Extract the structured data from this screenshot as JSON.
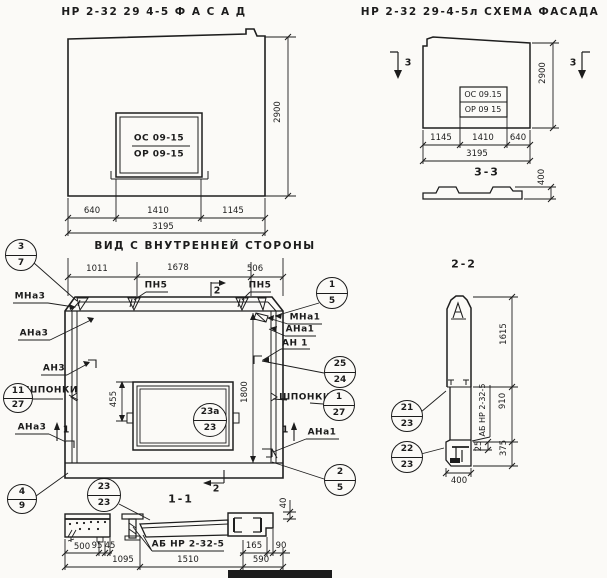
{
  "facade": {
    "title": "НР 2-32 29 4-5   Ф А С А Д",
    "window_top": "ОС 09-15",
    "window_bottom": "ОР 09-15",
    "dim_height": "2900",
    "dim_640": "640",
    "dim_1410": "1410",
    "dim_1145": "1145",
    "dim_total": "3195"
  },
  "scheme": {
    "title": "НР 2-32 29-4-5л  СХЕМА ФАСАДА",
    "window_top": "ОС 09.15",
    "window_bottom": "ОР 09 15",
    "dim_height": "2900",
    "dim_1145": "1145",
    "dim_1410": "1410",
    "dim_640": "640",
    "dim_total": "3195",
    "mark_left": "3",
    "mark_right": "3",
    "sec_title": "3-3",
    "dim_400": "400"
  },
  "inner": {
    "title": "ВИД С ВНУТРЕННЕЙ СТОРОНЫ",
    "dim_1011": "1011",
    "dim_1678": "1678",
    "dim_506": "506",
    "pn5_left": "ПН5",
    "pn5_right": "ПН5",
    "flag2_top": "2",
    "flag2_bottom": "2",
    "flag1_left": "1",
    "flag1_right": "1",
    "mna3": "МНа3",
    "ana3": "АНа3",
    "an3": "АН3",
    "shponki_left": "ШПОНКИ",
    "ana3_b": "АНа3",
    "mna1": "МНа1",
    "ana1": "АНа1",
    "an1": "АН 1",
    "shponki_right": "ШПОНКИ",
    "ana1_b": "АНа1",
    "dim_455": "455",
    "dim_1800": "1800"
  },
  "balloons": {
    "b3_7": {
      "top": "3",
      "bottom": "7"
    },
    "b11_27": {
      "top": "11",
      "bottom": "27"
    },
    "b4_9": {
      "top": "4",
      "bottom": "9"
    },
    "b1_5": {
      "top": "1",
      "bottom": "5"
    },
    "b25_24": {
      "top": "25",
      "bottom": "24"
    },
    "b1_27": {
      "top": "1",
      "bottom": "27"
    },
    "b2_5": {
      "top": "2",
      "bottom": "5"
    },
    "b23a_23": {
      "top": "23а",
      "bottom": "23"
    },
    "b21_23": {
      "top": "21",
      "bottom": "23"
    },
    "b22_23": {
      "top": "22",
      "bottom": "23"
    },
    "b23_23": {
      "top": "23",
      "bottom": "23"
    }
  },
  "section22": {
    "title": "2-2",
    "dim_1615": "1615",
    "dim_910": "910",
    "dim_375": "375",
    "dim_25": "25",
    "dim_400": "400",
    "label": "АБ НР 2-32-5"
  },
  "section11": {
    "title": "1-1",
    "label": "АБ НР 2-32-5",
    "dim_40": "40",
    "dim_500": "500",
    "dim_95": "95",
    "dim_45": "45",
    "dim_165": "165",
    "dim_90": "90",
    "dim_1095": "1095",
    "dim_1510": "1510",
    "dim_590": "590"
  }
}
